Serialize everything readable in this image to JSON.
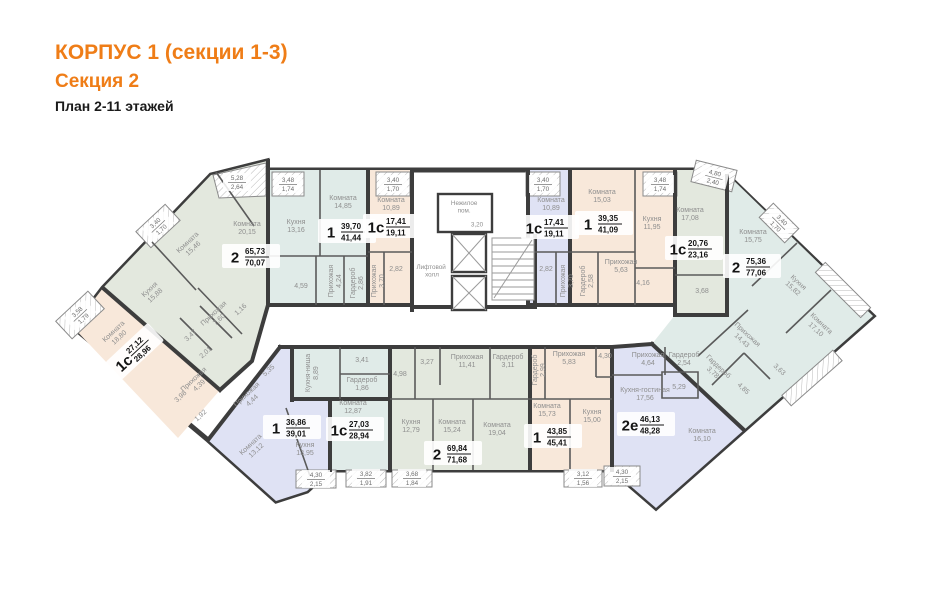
{
  "header": {
    "line1": "КОРПУС 1 (секции 1-3)",
    "line2": "Секция 2",
    "line3": "План 2-11 этажей"
  },
  "colors": {
    "accent": "#ef7d17",
    "sage": "#e3e8de",
    "peach": "#f8e8da",
    "cyan": "#e0ebe8",
    "lavender": "#dfe2f4",
    "wall": "#3d3d3d"
  },
  "core": {
    "elevator_hall_lines": [
      "Лифтовой",
      "холл"
    ],
    "non_residential_lines": [
      "Нежилое",
      "пом."
    ],
    "non_residential_area": "3,20"
  },
  "apartments": [
    {
      "id": "apt-2-left",
      "type": "2",
      "area_living": "65,73",
      "area_total": "70,07",
      "rooms": [
        {
          "name": "Комната",
          "area": "20,15"
        },
        {
          "name": "Комната",
          "area": "15,46"
        },
        {
          "name": "Кухня",
          "area": "15,88"
        },
        {
          "name": "Прихожая",
          "area": "7,60"
        },
        {
          "name": "",
          "area": "1,16"
        },
        {
          "name": "",
          "area": "3,47"
        },
        {
          "name": "",
          "area": "2,01"
        }
      ],
      "balconies": [
        {
          "a": "5,28",
          "b": "2,64"
        },
        {
          "a": "3,40",
          "b": "1,70"
        }
      ]
    },
    {
      "id": "apt-1s-left",
      "type": "1с",
      "area_living": "27,12",
      "area_total": "28,96",
      "rooms": [
        {
          "name": "Комната",
          "area": "18,80"
        },
        {
          "name": "Прихожая",
          "area": "4,39"
        },
        {
          "name": "",
          "area": "3,98"
        },
        {
          "name": "",
          "area": "1,92"
        }
      ],
      "balconies": [
        {
          "a": "3,58",
          "b": "1,79"
        }
      ]
    },
    {
      "id": "apt-1-center-left",
      "type": "1",
      "area_living": "39,70",
      "area_total": "41,44",
      "rooms": [
        {
          "name": "Комната",
          "area": "14,85"
        },
        {
          "name": "Кухня",
          "area": "13,16"
        },
        {
          "name": "Прихожая",
          "area": "4,24"
        },
        {
          "name": "Гардероб",
          "area": "2,86"
        },
        {
          "name": "",
          "area": "4,59"
        }
      ],
      "balconies": [
        {
          "a": "3,48",
          "b": "1,74"
        }
      ]
    },
    {
      "id": "apt-1s-center-left",
      "type": "1с",
      "area_living": "17,41",
      "area_total": "19,11",
      "rooms": [
        {
          "name": "Комната",
          "area": "10,89"
        },
        {
          "name": "Прихожая",
          "area": "3,70"
        },
        {
          "name": "",
          "area": "2,82"
        }
      ],
      "balconies": [
        {
          "a": "3,40",
          "b": "1,70"
        }
      ]
    },
    {
      "id": "apt-1s-center-right",
      "type": "1с",
      "area_living": "17,41",
      "area_total": "19,11",
      "rooms": [
        {
          "name": "Комната",
          "area": "10,89"
        },
        {
          "name": "Прихожая",
          "area": "3,70"
        },
        {
          "name": "",
          "area": "2,82"
        }
      ],
      "balconies": [
        {
          "a": "3,40",
          "b": "1,70"
        }
      ]
    },
    {
      "id": "apt-1-center-right",
      "type": "1",
      "area_living": "39,35",
      "area_total": "41,09",
      "rooms": [
        {
          "name": "Комната",
          "area": "15,03"
        },
        {
          "name": "Кухня",
          "area": "11,95"
        },
        {
          "name": "Прихожая",
          "area": "5,63"
        },
        {
          "name": "Гардероб",
          "area": "2,58"
        },
        {
          "name": "",
          "area": "4,16"
        }
      ],
      "balconies": [
        {
          "a": "3,48",
          "b": "1,74"
        }
      ]
    },
    {
      "id": "apt-1s-right",
      "type": "1с",
      "area_living": "20,76",
      "area_total": "23,16",
      "rooms": [
        {
          "name": "Комната",
          "area": "17,08"
        },
        {
          "name": "",
          "area": "3,68"
        }
      ],
      "balconies": [
        {
          "a": "4,80",
          "b": "2,40"
        }
      ]
    },
    {
      "id": "apt-2-right",
      "type": "2",
      "area_living": "75,36",
      "area_total": "77,06",
      "rooms": [
        {
          "name": "Комната",
          "area": "15,75"
        },
        {
          "name": "Кухня",
          "area": "15,82"
        },
        {
          "name": "Комната",
          "area": "17,10"
        },
        {
          "name": "Прихожая",
          "area": "14,43"
        },
        {
          "name": "Гардероб",
          "area": "3,78"
        },
        {
          "name": "",
          "area": "4,85"
        },
        {
          "name": "",
          "area": "3,63"
        }
      ],
      "balconies": [
        {
          "a": "3,40",
          "b": "1,70"
        }
      ]
    },
    {
      "id": "apt-2e-right",
      "type": "2е",
      "area_living": "46,13",
      "area_total": "48,28",
      "rooms": [
        {
          "name": "Кухня-гостиная",
          "area": "17,56"
        },
        {
          "name": "Комната",
          "area": "16,10"
        },
        {
          "name": "Прихожая",
          "area": "4,64"
        },
        {
          "name": "Гардероб",
          "area": "2,54"
        },
        {
          "name": "",
          "area": "5,29"
        }
      ],
      "balconies": [
        {
          "a": "4,30",
          "b": "2,15"
        }
      ]
    },
    {
      "id": "apt-1-bottom-left",
      "type": "1",
      "area_living": "36,86",
      "area_total": "39,01",
      "rooms": [
        {
          "name": "Комната",
          "area": "13,12"
        },
        {
          "name": "Кухня",
          "area": "13,95"
        },
        {
          "name": "Прихожая",
          "area": "4,44"
        },
        {
          "name": "",
          "area": "5,35"
        }
      ],
      "balconies": [
        {
          "a": "4,30",
          "b": "2,15"
        }
      ]
    },
    {
      "id": "apt-1s-bottom",
      "type": "1с",
      "area_living": "27,03",
      "area_total": "28,94",
      "rooms": [
        {
          "name": "Комната",
          "area": "12,87"
        },
        {
          "name": "Кухня-ниша",
          "area": "8,89"
        },
        {
          "name": "Гардероб",
          "area": "1,86"
        },
        {
          "name": "",
          "area": "3,41"
        }
      ],
      "balconies": [
        {
          "a": "3,82",
          "b": "1,91"
        }
      ]
    },
    {
      "id": "apt-2-bottom",
      "type": "2",
      "area_living": "69,84",
      "area_total": "71,68",
      "rooms": [
        {
          "name": "Комната",
          "area": "15,24"
        },
        {
          "name": "Комната",
          "area": "19,04"
        },
        {
          "name": "Кухня",
          "area": "12,79"
        },
        {
          "name": "Прихожая",
          "area": "11,41"
        },
        {
          "name": "Гардероб",
          "area": "3,11"
        },
        {
          "name": "",
          "area": "3,27"
        },
        {
          "name": "",
          "area": "4,98"
        }
      ],
      "balconies": [
        {
          "a": "3,68",
          "b": "1,84"
        }
      ]
    },
    {
      "id": "apt-1-bottom-right",
      "type": "1",
      "area_living": "43,85",
      "area_total": "45,41",
      "rooms": [
        {
          "name": "Комната",
          "area": "15,73"
        },
        {
          "name": "Кухня",
          "area": "15,00"
        },
        {
          "name": "Прихожая",
          "area": "5,83"
        },
        {
          "name": "Гардероб",
          "area": "2,99"
        },
        {
          "name": "",
          "area": "4,30"
        }
      ],
      "balconies": [
        {
          "a": "3,12",
          "b": "1,56"
        }
      ]
    }
  ]
}
